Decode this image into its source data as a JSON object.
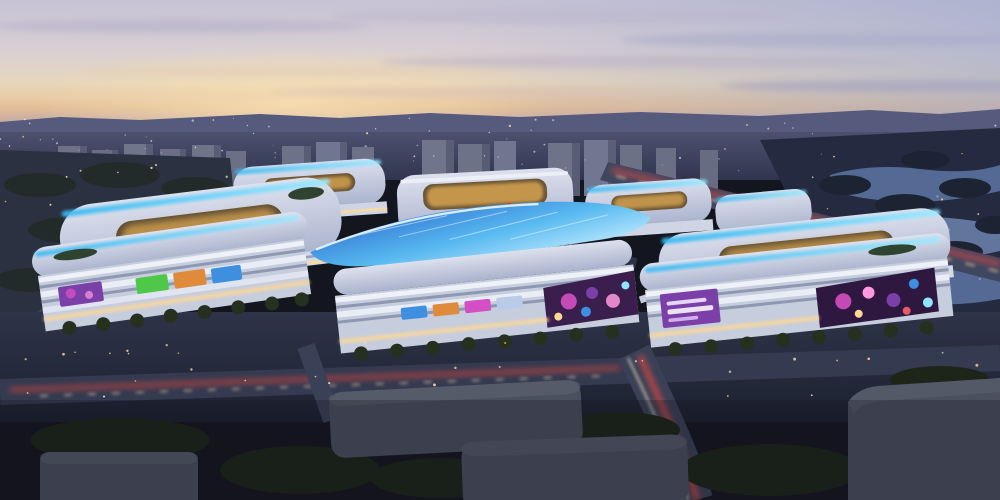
{
  "scene": {
    "kind": "architectural-rendering",
    "subject": "aerial dusk view of an illuminated shopping-mall complex with looping LED-edged roofs, residential towers behind, wetland lake to the right and dark massing blocks in the foreground",
    "time_of_day": "dusk"
  },
  "palette": {
    "sky_top": "#c7c3d5",
    "sky_upper_mid": "#d8cfd3",
    "sky_cream": "#e7d6bc",
    "sky_peach": "#e3bd96",
    "sky_mauve": "#b29fb2",
    "sky_horizon": "#8b88a9",
    "hills": "#565a7d",
    "city_plain_top": "#4c516f",
    "city_plain_bottom": "#30354f",
    "tower_face": "#6d7289",
    "tower_side": "#585d75",
    "roof_light": "#dde1ee",
    "roof_shade": "#aab3cd",
    "facade_light": "#e9edf6",
    "facade_dark": "#8f98b2",
    "led_cyan": "#5fd4ff",
    "led_deep": "#2f6fd0",
    "window_warm": "#ffd894",
    "courtyard_gold": "#c99a4e",
    "media_magenta": "#d44fc4",
    "media_purple": "#7b3fa8",
    "media_green": "#4fc84a",
    "media_orange": "#e08a3c",
    "media_blue": "#3f8fe0",
    "logo_red": "#d1312e",
    "road": "#2b3044",
    "road_light": "#3a4156",
    "trail_red": "#ff4a3a",
    "trail_white": "#ffe9c9",
    "tree_dark": "#20291c",
    "tree_park": "#1f2734",
    "water": "#5a719f",
    "water_bright": "#7b92c0",
    "box_gray": "#4b505f",
    "box_gray_top": "#5a5f6e",
    "lamp": "#ffcf8e",
    "glow_warm": "#f8e0b2"
  },
  "landmarks": {
    "logo_badge": {
      "shape": "red circle with red wordmark band",
      "color": "#d1312e"
    },
    "purple_billboard": {
      "shape": "purple LED banner with white glyphs",
      "color": "#7b3fa8"
    },
    "canopy": {
      "shape": "leaf-shaped LED roof canopy",
      "color": "#2f6fd0"
    }
  },
  "counts": {
    "foreground_mall_blocks": 3,
    "midground_ring_blocks": 5,
    "foreground_massing_boxes": 4
  }
}
